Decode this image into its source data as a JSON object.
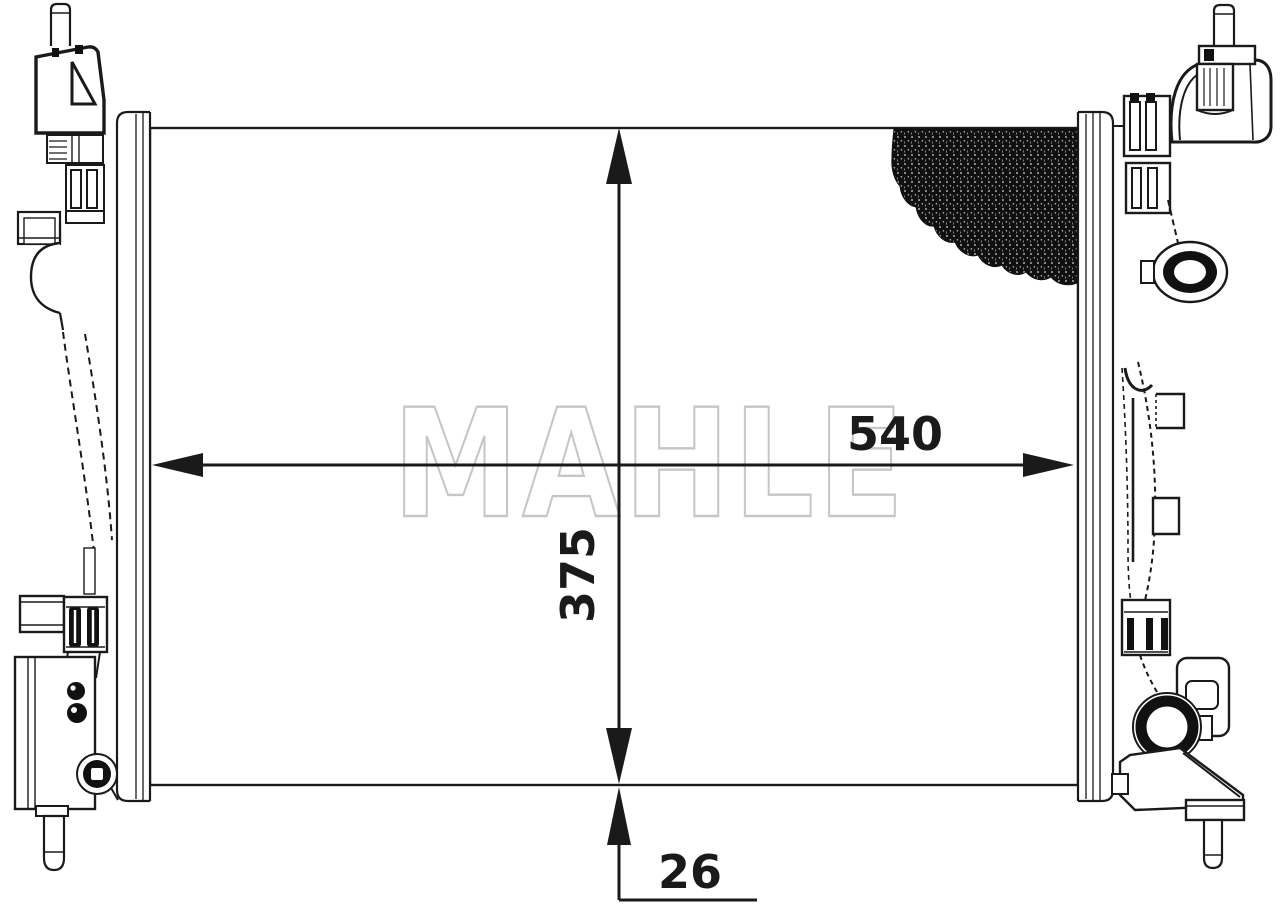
{
  "watermark": "MAHLE",
  "dimensions": {
    "width": "540",
    "height": "375",
    "depth": "26"
  },
  "colors": {
    "line": "#1a1a1a",
    "watermark": "#c6c6c6",
    "background": "#ffffff"
  }
}
